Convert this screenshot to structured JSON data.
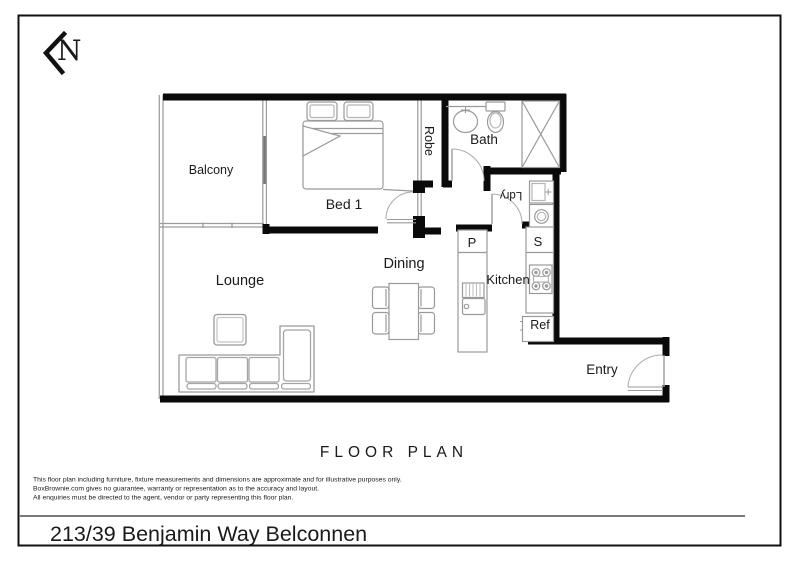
{
  "page": {
    "address": "213/39 Benjamin Way Belconnen",
    "plan_title": "FLOOR PLAN",
    "compass_letter": "N"
  },
  "rooms": {
    "balcony": "Balcony",
    "bed1": "Bed 1",
    "robe": "Robe",
    "bath": "Bath",
    "laundry": "Ldry",
    "lounge": "Lounge",
    "dining": "Dining",
    "kitchen": "Kitchen",
    "pantry": "P",
    "store": "S",
    "fridge": "Ref",
    "entry": "Entry"
  },
  "disclaimer": {
    "lines": [
      "This floor plan including furniture, fixture measurements and dimensions are approximate and for illustrative purposes only.",
      "BoxBrownie.com gives no guarantee, warranty or representation as to the accuracy and layout.",
      "All enquiries must be directed to the agent, vendor or party representing this floor plan."
    ]
  },
  "colors": {
    "wall": "#0a0a0a",
    "furniture_outline": "#9a9a9a",
    "door_swing": "#aaaaaa",
    "text": "#1a1a1a",
    "separator": "#7a7a7a"
  }
}
